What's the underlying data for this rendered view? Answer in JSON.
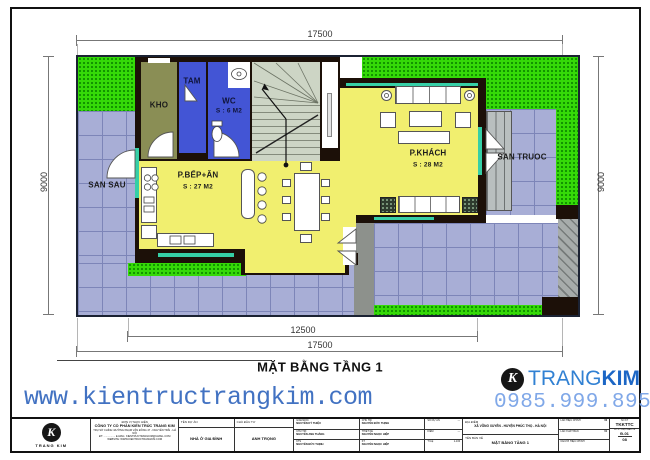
{
  "sheet": {
    "drawing_title": "MẶT BẰNG TẦNG 1",
    "website": "www.kientructrangkim.com",
    "phone": "0985.999.895",
    "logo": {
      "letter": "K",
      "name_regular": "TRANG",
      "name_bold": "KIM"
    }
  },
  "dims": {
    "top": "17500",
    "bottom_inner": "12500",
    "bottom_outer": "17500",
    "left": "9000",
    "right": "9000"
  },
  "plan": {
    "rooms": {
      "kho": {
        "label": "KHO"
      },
      "tam": {
        "label": "TAM"
      },
      "wc": {
        "label": "WC",
        "area": "S : 6 M2"
      },
      "bep": {
        "label": "P.BẾP+ĂN",
        "area": "S : 27 M2"
      },
      "khach": {
        "label": "P.KHÁCH",
        "area": "S : 28 M2"
      },
      "san_sau": {
        "label": "SAN SAU"
      },
      "san_truoc": {
        "label": "SAN TRUOC"
      }
    }
  },
  "title_block": {
    "unit_heading": "ĐƠN VỊ THỰC HIỆN",
    "company": "CÔNG TY CỔ PHẦN KIẾN TRÚC TRANG KIM",
    "address": "TRỤ SỞ CHÍNH: ĐƯỜNG PHẠM VĂN ĐỒNG 47 - NGUYỄN TRÃI - HÀ NỘI",
    "contact": "ĐT: ................  E-MAIL: KIENTRUCTRANGKIM@GMAIL.COM",
    "website_line": "WEBSITE: WWW.KIENTRUCTRANGKIM.COM",
    "logo_caption": "TRANG KIM",
    "project_label": "TÊN DỰ ÁN",
    "project_value": "NHÀ Ở GIA ĐÌNH",
    "investor_label": "CHỦ ĐẦU TƯ",
    "investor_value": "ANH TRỌNG",
    "names_a": [
      {
        "role": "GIÁM ĐỐC",
        "name": "NGUYỄN KỲ THIỆU"
      },
      {
        "role": "CHỦ TRÌ",
        "name": "NGUYỄN ANH THẮNG"
      },
      {
        "role": "KTS",
        "name": "NGUYỄN ĐỨC THỊNH"
      }
    ],
    "names_b": [
      {
        "role": "CHỦ TRÌ",
        "name": "NGUYỄN ĐỨC THỊNH"
      },
      {
        "role": "THIẾT KẾ",
        "name": "NGUYỄN NGỌC HIỆP"
      },
      {
        "role": "KT",
        "name": "NGUYỄN NGỌC HIỆP"
      }
    ],
    "meta": [
      {
        "label": "SỐ DỰ ÁN",
        "value": "—"
      },
      {
        "label": "KIỂM",
        "value": "—"
      },
      {
        "label": "TỈ LỆ",
        "value": "1-100"
      }
    ],
    "location_label": "ĐỊA ĐIỂM",
    "location_value": "XÃ VÕNG XUYÊN - HUYỆN PHÚC THỌ - HÀ NỘI",
    "drawing_label": "TÊN BẢN VẼ",
    "drawing_value": "MẶT BẰNG TẦNG 1",
    "revisions": [
      {
        "label": "LẦN HIỆU CHỈNH",
        "value": "00"
      },
      {
        "label": "LẦN XUẤT BẢN",
        "value": "01"
      },
      {
        "label": "NGƯỜI HIỆU CHỈNH",
        "value": ""
      }
    ],
    "code_label": "SỐ KT",
    "code_value": "TKKTTC",
    "sheet_label": "SỐ KÝ HIỆU BẢN VẼ",
    "sheet_no": "Đ-01",
    "sheet_total": "08"
  }
}
